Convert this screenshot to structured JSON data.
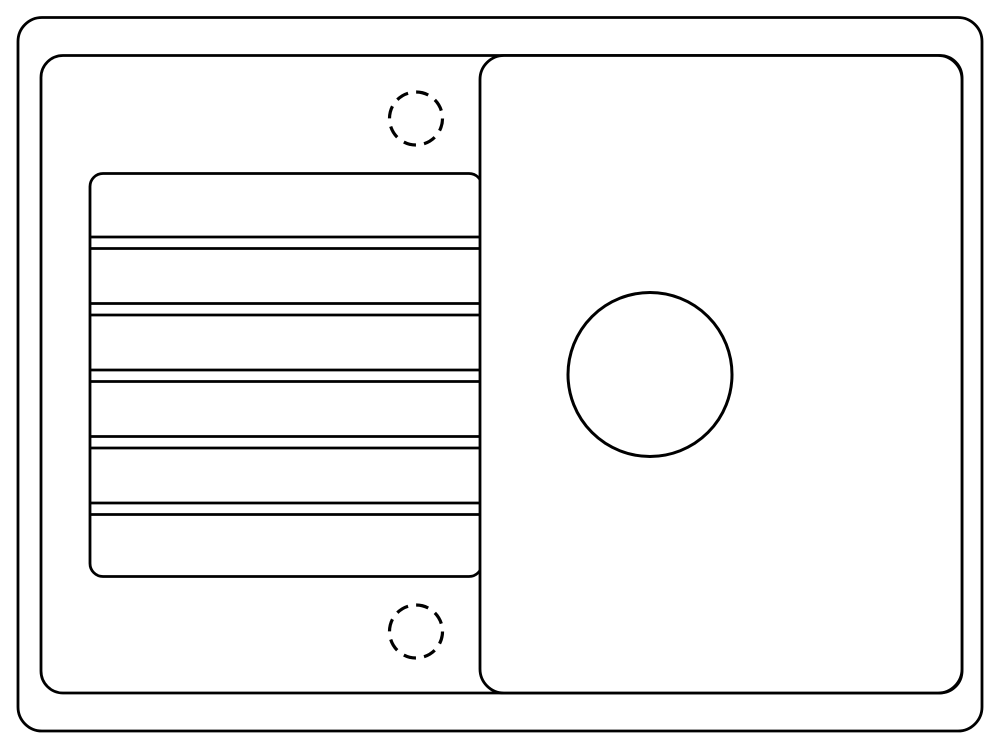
{
  "canvas": {
    "width": 1000,
    "height": 740,
    "background": "#ffffff",
    "stroke_color": "#000000"
  },
  "sink_diagram": {
    "description": "top-view line drawing of a kitchen sink with left drainboard and right bowl",
    "shapes": [
      {
        "name": "sink-outer-edge",
        "type": "rect",
        "x": 18,
        "y": 17.5,
        "width": 964,
        "height": 713.5,
        "rx": 24,
        "stroke_width": 2.8,
        "fill": "none"
      },
      {
        "name": "sink-inner-rim",
        "type": "rect",
        "x": 41,
        "y": 55.5,
        "width": 921,
        "height": 637.5,
        "rx": 22,
        "stroke_width": 2.8,
        "fill": "none"
      },
      {
        "name": "drainboard-outline",
        "type": "rect",
        "x": 90,
        "y": 173.5,
        "width": 392,
        "height": 403,
        "rx": 13,
        "stroke_width": 2.8,
        "fill": "#ffffff"
      },
      {
        "name": "drainboard-groove-line-1a",
        "type": "line",
        "x1": 90,
        "y1": 237,
        "x2": 482,
        "y2": 237,
        "stroke_width": 2.8
      },
      {
        "name": "drainboard-groove-line-1b",
        "type": "line",
        "x1": 90,
        "y1": 248.5,
        "x2": 482,
        "y2": 248.5,
        "stroke_width": 2.8
      },
      {
        "name": "drainboard-groove-line-2a",
        "type": "line",
        "x1": 90,
        "y1": 303.5,
        "x2": 482,
        "y2": 303.5,
        "stroke_width": 2.8
      },
      {
        "name": "drainboard-groove-line-2b",
        "type": "line",
        "x1": 90,
        "y1": 315,
        "x2": 482,
        "y2": 315,
        "stroke_width": 2.8
      },
      {
        "name": "drainboard-groove-line-3a",
        "type": "line",
        "x1": 90,
        "y1": 370,
        "x2": 482,
        "y2": 370,
        "stroke_width": 2.8
      },
      {
        "name": "drainboard-groove-line-3b",
        "type": "line",
        "x1": 90,
        "y1": 381.5,
        "x2": 482,
        "y2": 381.5,
        "stroke_width": 2.8
      },
      {
        "name": "drainboard-groove-line-4a",
        "type": "line",
        "x1": 90,
        "y1": 436.5,
        "x2": 482,
        "y2": 436.5,
        "stroke_width": 2.8
      },
      {
        "name": "drainboard-groove-line-4b",
        "type": "line",
        "x1": 90,
        "y1": 448,
        "x2": 482,
        "y2": 448,
        "stroke_width": 2.8
      },
      {
        "name": "drainboard-groove-line-5a",
        "type": "line",
        "x1": 90,
        "y1": 503,
        "x2": 482,
        "y2": 503,
        "stroke_width": 2.8
      },
      {
        "name": "drainboard-groove-line-5b",
        "type": "line",
        "x1": 90,
        "y1": 514.5,
        "x2": 482,
        "y2": 514.5,
        "stroke_width": 2.8
      },
      {
        "name": "bowl-outline",
        "type": "rect",
        "x": 480,
        "y": 55.5,
        "width": 482,
        "height": 637.5,
        "rx": 24,
        "stroke_width": 2.8,
        "fill": "#ffffff"
      },
      {
        "name": "drain-hole",
        "type": "circle",
        "cx": 650,
        "cy": 374.5,
        "r": 82,
        "stroke_width": 3,
        "fill": "none"
      },
      {
        "name": "tap-hole-top",
        "type": "circle",
        "cx": 416,
        "cy": 118.5,
        "r": 26.5,
        "stroke_width": 3.2,
        "fill": "none",
        "dash": "12.6 8.2"
      },
      {
        "name": "tap-hole-bottom",
        "type": "circle",
        "cx": 416,
        "cy": 631.5,
        "r": 26.5,
        "stroke_width": 3.2,
        "fill": "none",
        "dash": "12.6 8.2"
      }
    ]
  }
}
